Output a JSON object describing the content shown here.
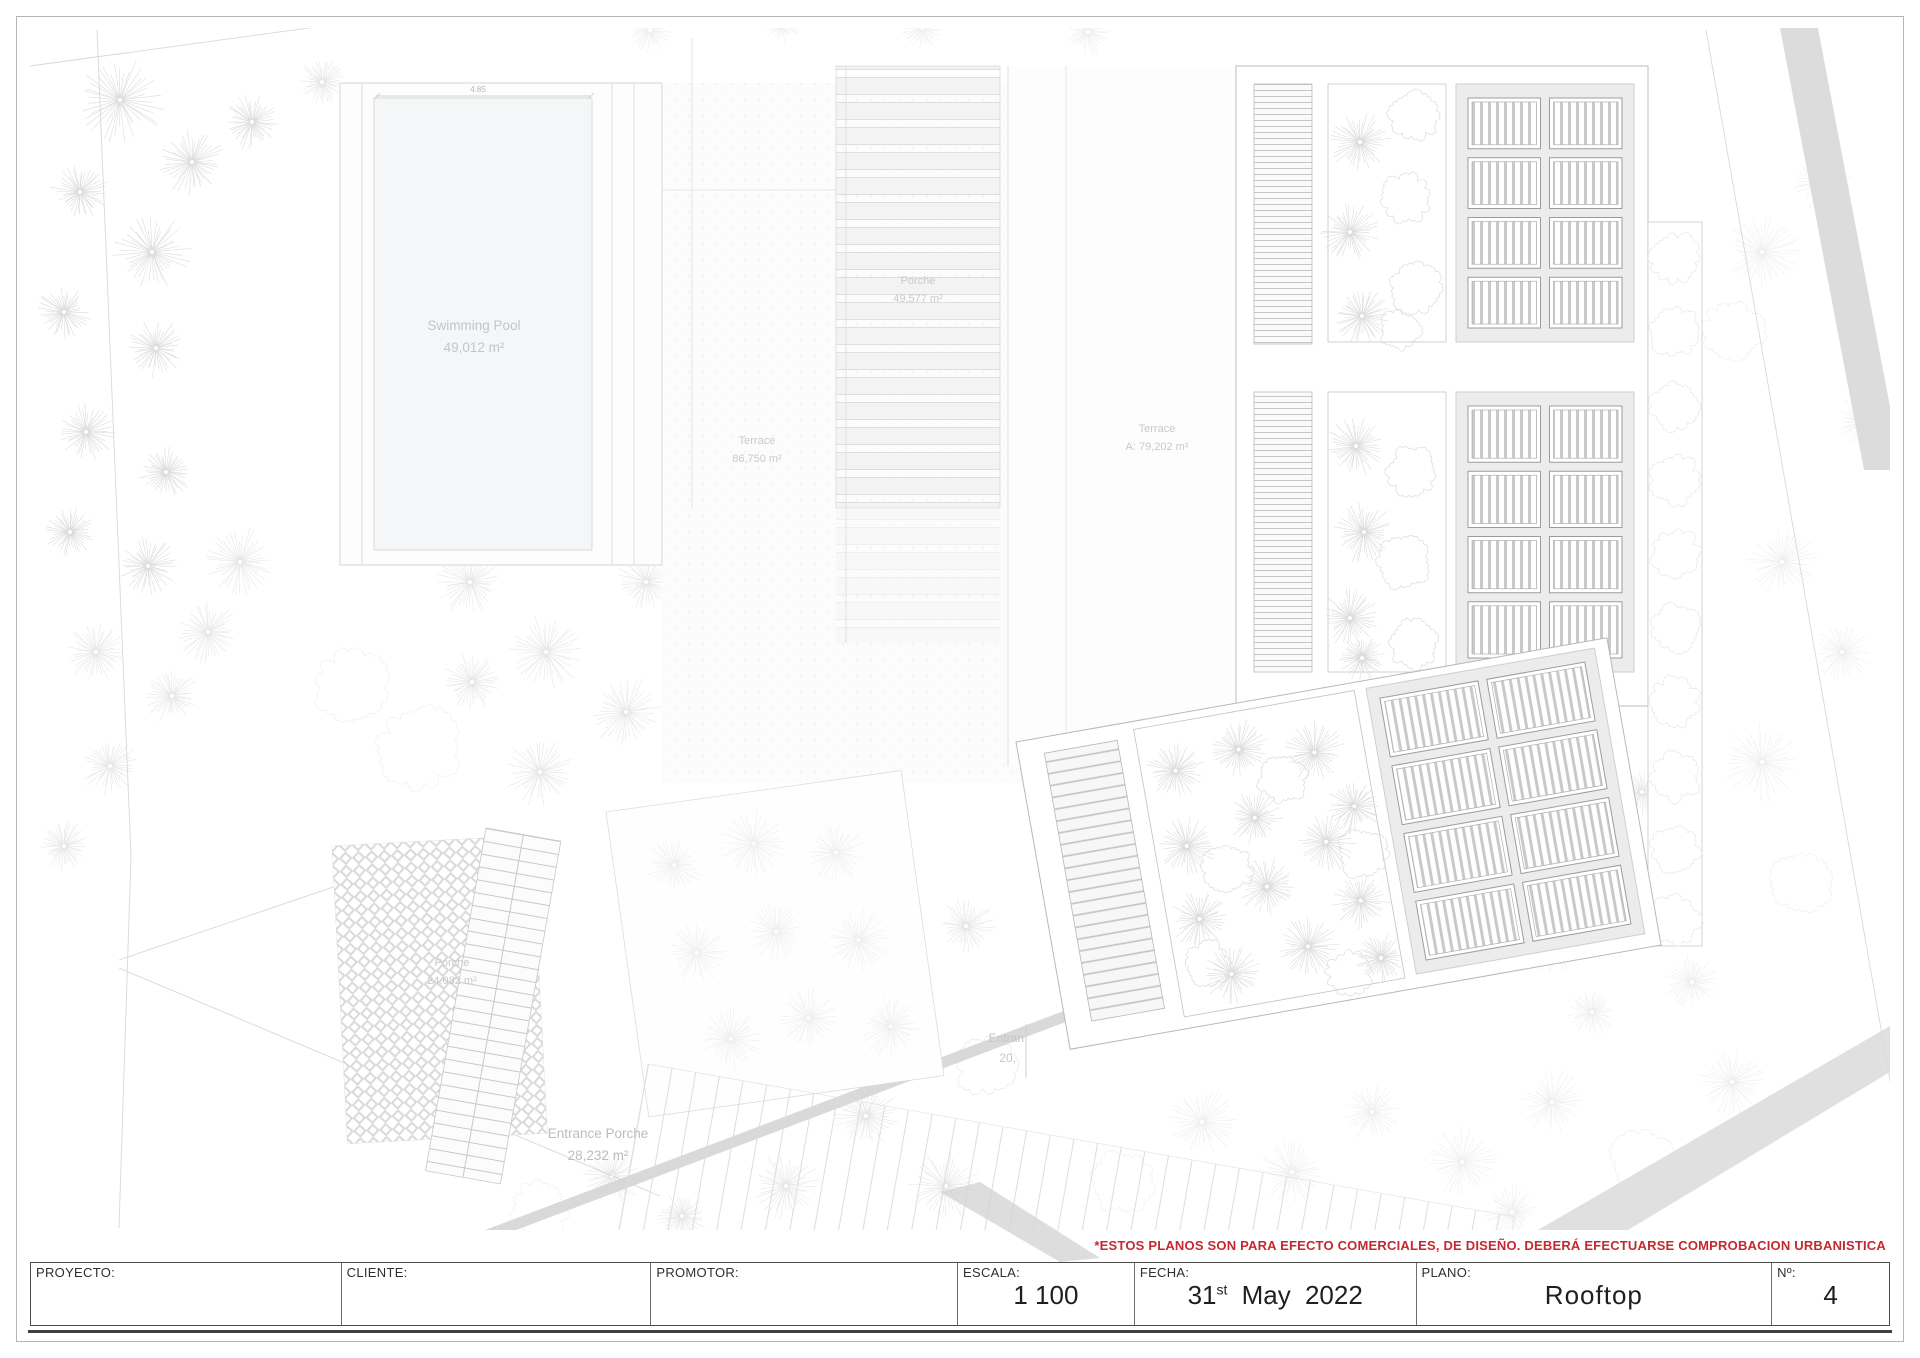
{
  "sheet": {
    "disclaimer": "*ESTOS PLANOS SON PARA EFECTO COMERCIALES, DE DISEÑO. DEBERÁ EFECTUARSE COMPROBACION URBANISTICA"
  },
  "colors": {
    "disclaimer_red": "#c5292f",
    "linework_gray": "#c8c8c8",
    "solar_area_fill": "#ececec",
    "road_gray": "#d8d8d8"
  },
  "plan": {
    "labels": {
      "swimming_pool": {
        "title": "Swimming Pool",
        "area": "49,012 m²"
      },
      "porche_pergola": {
        "title": "Porche",
        "area": "49,577 m²"
      },
      "terrace_main": {
        "title": "Terrace",
        "area": "86,750 m²"
      },
      "terrace_a": {
        "title": "Terrace",
        "area": "A: 79,202 m²"
      },
      "porche_entry": {
        "title": "Porche",
        "area": "24,082 m²"
      },
      "entrance_porche": {
        "title": "Entrance Porche",
        "area": "28,232 m²"
      },
      "entrance_clipped_1": "Entran",
      "entrance_clipped_2": "20,",
      "pool_dim": "4.85"
    }
  },
  "title_block": {
    "proyecto": {
      "label": "PROYECTO:",
      "value": ""
    },
    "cliente": {
      "label": "CLIENTE:",
      "value": ""
    },
    "promotor": {
      "label": "PROMOTOR:",
      "value": ""
    },
    "escala": {
      "label": "ESCALA:",
      "value": "1 100"
    },
    "fecha": {
      "label": "FECHA:",
      "day": "31",
      "ordinal": "st",
      "rest": " May 2022"
    },
    "plano": {
      "label": "PLANO:",
      "value": "Rooftop"
    },
    "numero": {
      "label": "Nº:",
      "value": "4"
    }
  }
}
